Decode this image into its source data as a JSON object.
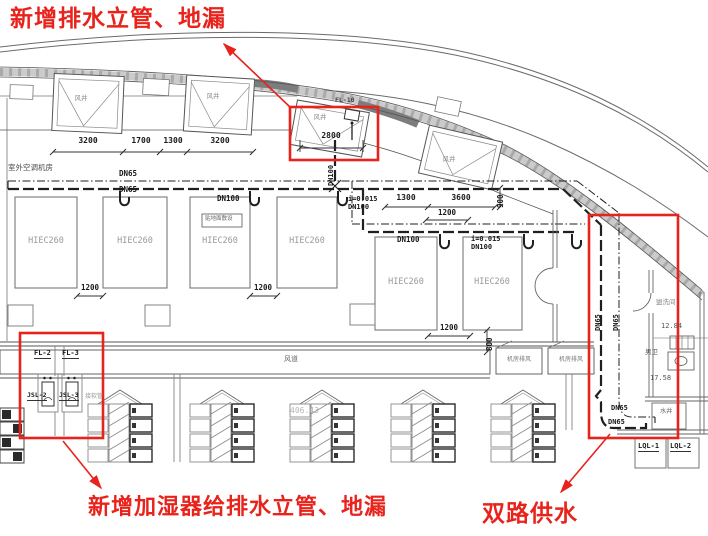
{
  "drawing_red": "#e8231c",
  "annotations": {
    "top": "新增排水立管、地漏",
    "bottom_left": "新增加湿器给排水立管、地漏",
    "bottom_right": "双路供水"
  },
  "labels": {
    "outdoor_ac_room": "室外空调机房",
    "air_duct": "风道",
    "washroom": "盥洗间",
    "mens_toilet": "男卫",
    "water_shaft": "水井",
    "floor_laid_note": "贴地面敷设",
    "hose_note": "接软管",
    "elev_washroom": "12.84",
    "elev_toilet": "17.58",
    "elev_duct": "406.43"
  },
  "air_shafts": [
    "风井",
    "风井",
    "风井",
    "风井"
  ],
  "exhaust_boxes": [
    "机房排风",
    "机房排风"
  ],
  "ahu_units": [
    "HIEC260",
    "HIEC260",
    "HIEC260",
    "HIEC260",
    "HIEC260",
    "HIEC260"
  ],
  "pipe_labels": {
    "main_upper": "DN65",
    "main_lower": "DN65",
    "row1_dn100": "DN100",
    "row1_slope": "i=0.015",
    "row1_slope_dn": "DN100",
    "riser_dn100": "DN100",
    "row2_dn100": "DN100",
    "row2_slope": "i=0.015",
    "row2_slope_dn": "DN100",
    "east_riser_a": "DN65",
    "east_riser_b": "DN65",
    "supply_a": "DN65",
    "supply_b": "DN65",
    "roof_drain": "FL-10",
    "floor_drain_a": "FL-2",
    "floor_drain_b": "FL-3",
    "humidifier_a": "JSL-2",
    "humidifier_b": "JSL-3",
    "chilled_a": "LQL-1",
    "chilled_b": "LQL-2"
  },
  "dimensions": {
    "top_row": [
      "3200",
      "1700",
      "1300",
      "3200"
    ],
    "shaft_width": "2800",
    "mid_row": [
      "1300",
      "3600"
    ],
    "mid_vertical": "900",
    "mid_gap": "1200",
    "gap_1_2": "1200",
    "gap_3_4": "1200",
    "row2_gap": "1200",
    "row2_vertical": "800"
  }
}
